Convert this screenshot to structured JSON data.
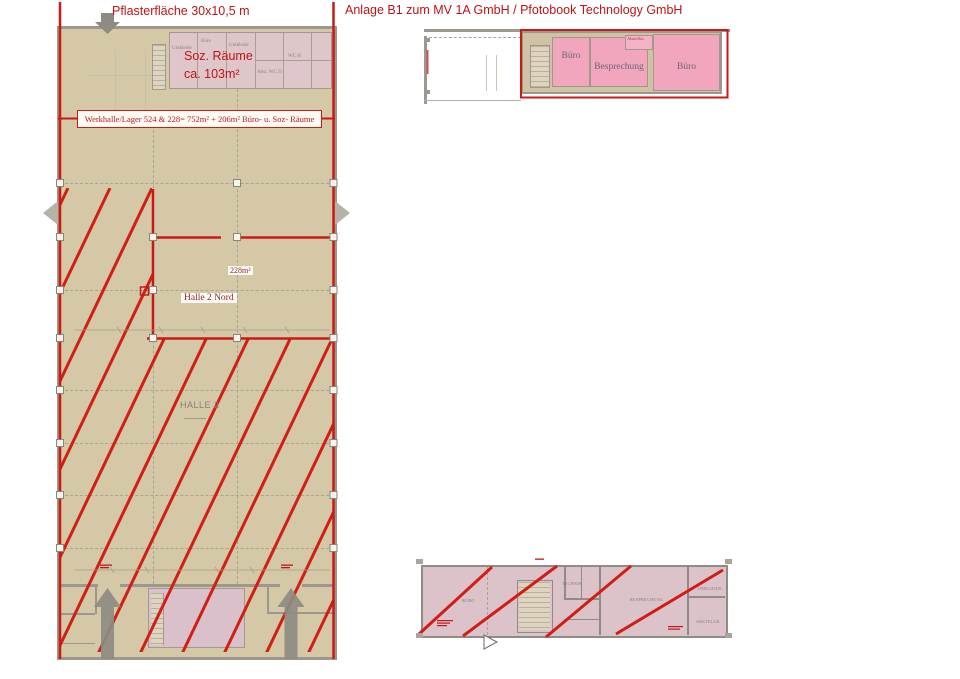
{
  "header": {
    "paving": "Pflasterfläche 30x10,5 m",
    "title": "Anlage B1 zum MV 1A GmbH / Pfotobook Technology GmbH"
  },
  "hall_plan": {
    "soz1": "Soz. Räume",
    "soz2": "ca. 103m²",
    "note": "Werkhalle/Lager 524 & 228= 752m² + 206m² Büro- u. Soz- Räume",
    "area": "228m²",
    "nord": "Halle 2 Nord",
    "halle": "HALLE 2",
    "rooms": {
      "umkleide1": "Umkleide",
      "buero": "Büro",
      "umkleide2": "Umkleide",
      "wc": "WC H",
      "abst": "Abst. WC D"
    }
  },
  "upper_plan": {
    "buero_left": "Büro",
    "besprechung": "Besprechung",
    "buero_right": "Büro",
    "abstell": "Abstellra."
  },
  "lower_plan": {
    "buero": "BÜRO",
    "technik": "TECHNIK",
    "besprechung": "BESPRECHUNG",
    "umkleide": "UMKLEIDE",
    "abstell": "ABSTELLR."
  },
  "colors": {
    "line_red": "#cb1a14",
    "header_red": "#bf1317",
    "label_maroon": "#8c2a32",
    "hall_tan": "#d5c8a6",
    "soz_pink": "#dfc6cb",
    "room_pink": "#f1a6be",
    "lower_pink": "#dcc3c9",
    "wall_gray": "#9c9890",
    "arrow_gray": "#8e8b83"
  }
}
